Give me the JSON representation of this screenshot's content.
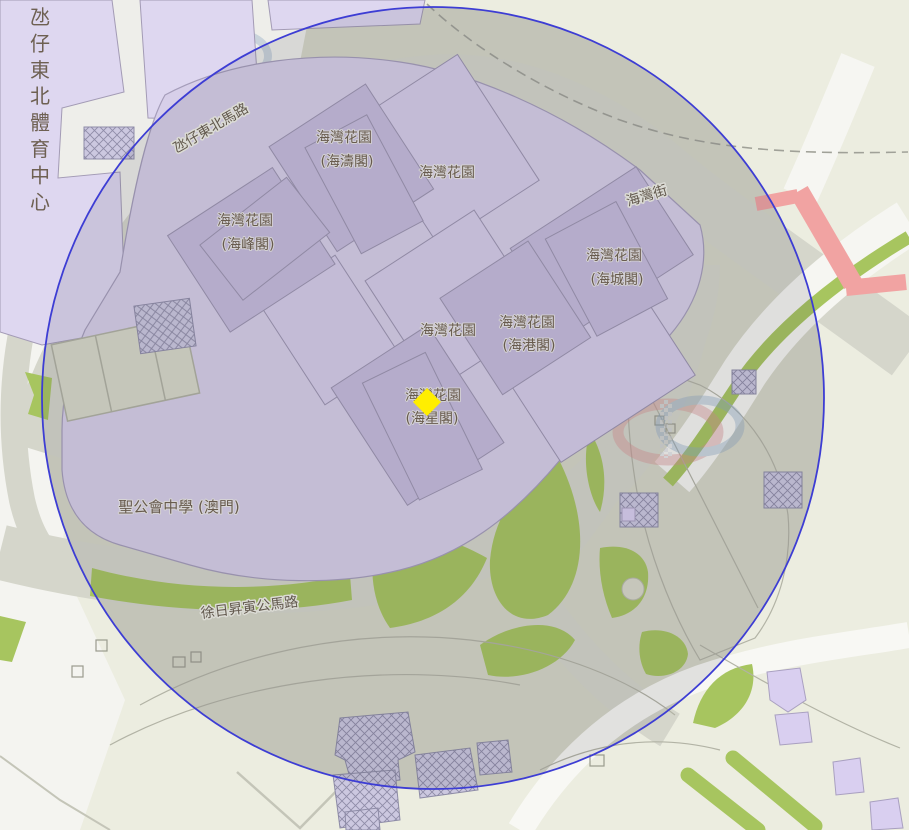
{
  "map": {
    "area_labels": {
      "sports_centre": "氹仔東北體育中心",
      "school": "聖公會中學 (澳門)"
    },
    "road_labels": {
      "northeast_road": "氹仔東北馬路",
      "bay_street": "海灣街",
      "south_road": "徐日昇寅公馬路"
    },
    "building_labels": {
      "garden": "海灣花園",
      "block_hoi_tou": "(海濤閣)",
      "block_hoi_fung": "(海峰閣)",
      "block_hoi_seng": "(海城閣)",
      "block_hoi_kong": "(海港閣)",
      "block_hoi_sing": "(海星閣)"
    },
    "overlay": {
      "shape": "circle",
      "stroke_color": "#3d3dd4",
      "description": "radius circle centered near marker"
    },
    "marker": {
      "shape": "diamond",
      "color": "#ffee00"
    },
    "colors": {
      "background": "#ecede0",
      "ground_inside_circle": "#d6d7c7",
      "road": "#d5d6cb",
      "building_tower": "#c6bcdd",
      "building_podium": "#d6cdea",
      "sports_centre_building": "#ded7f0",
      "green": "#a7c55f",
      "red_road": "#f1a3a2",
      "plaza_inner": "#e7e7da",
      "boundary_dash": "#a0a198"
    }
  }
}
